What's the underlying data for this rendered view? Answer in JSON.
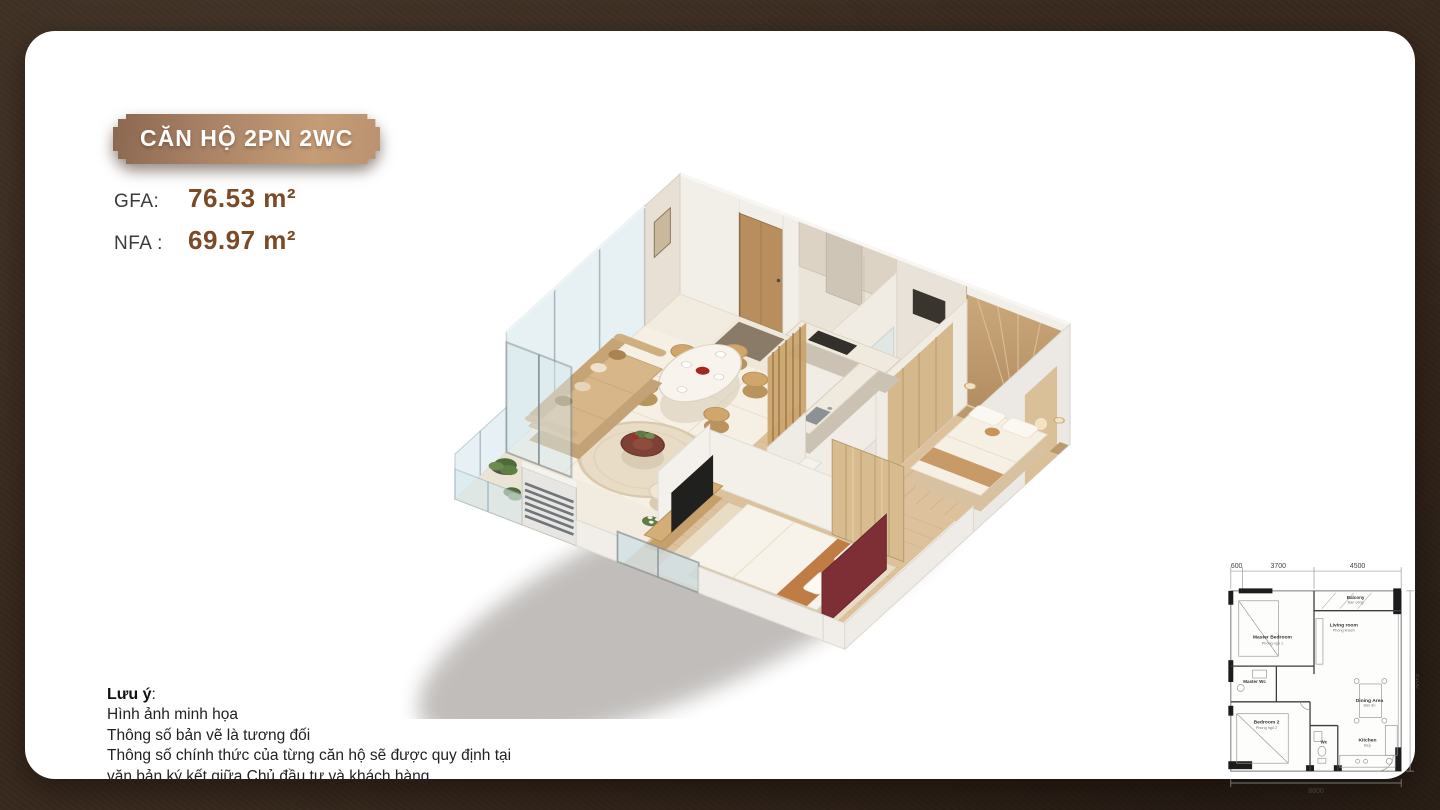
{
  "badge": {
    "label": "CĂN HỘ 2PN 2WC"
  },
  "areas": {
    "gfa": {
      "label": "GFA:",
      "value": "76.53 m²"
    },
    "nfa": {
      "label": "NFA :",
      "value": "69.97 m²"
    }
  },
  "note": {
    "title": "Lưu ý",
    "colon": ":",
    "lines": [
      "Hình ảnh minh họa",
      "Thông số bản vẽ là tương đối",
      "Thông số chính thức của từng căn hộ sẽ được quy định tại",
      "văn bản ký kết giữa Chủ đầu tư và khách hàng."
    ]
  },
  "colors": {
    "page_bg": "#392a1e",
    "accent_brown": "#7b4a27",
    "badge_from": "#8a6750",
    "badge_to": "#c49c77"
  },
  "mini_plan": {
    "dims": {
      "top_left": "600",
      "top_mid": "3700",
      "top_right": "4500",
      "right": "9100",
      "bottom": "8800"
    },
    "rooms": {
      "master_bedroom": {
        "en": "Master Bedroom",
        "vi": "Phòng ngủ 1"
      },
      "master_wc": {
        "en": "Master Wc",
        "vi": ""
      },
      "bedroom2": {
        "en": "Bedroom 2",
        "vi": "Phòng ngủ 2"
      },
      "wc": {
        "en": "Wc",
        "vi": ""
      },
      "kitchen": {
        "en": "Kitchen",
        "vi": "Bếp"
      },
      "dining": {
        "en": "Dining Area",
        "vi": "Bàn ăn"
      },
      "living": {
        "en": "Living room",
        "vi": "Phòng khách"
      },
      "balcony": {
        "en": "Balcony",
        "vi": "Ban công"
      }
    }
  }
}
